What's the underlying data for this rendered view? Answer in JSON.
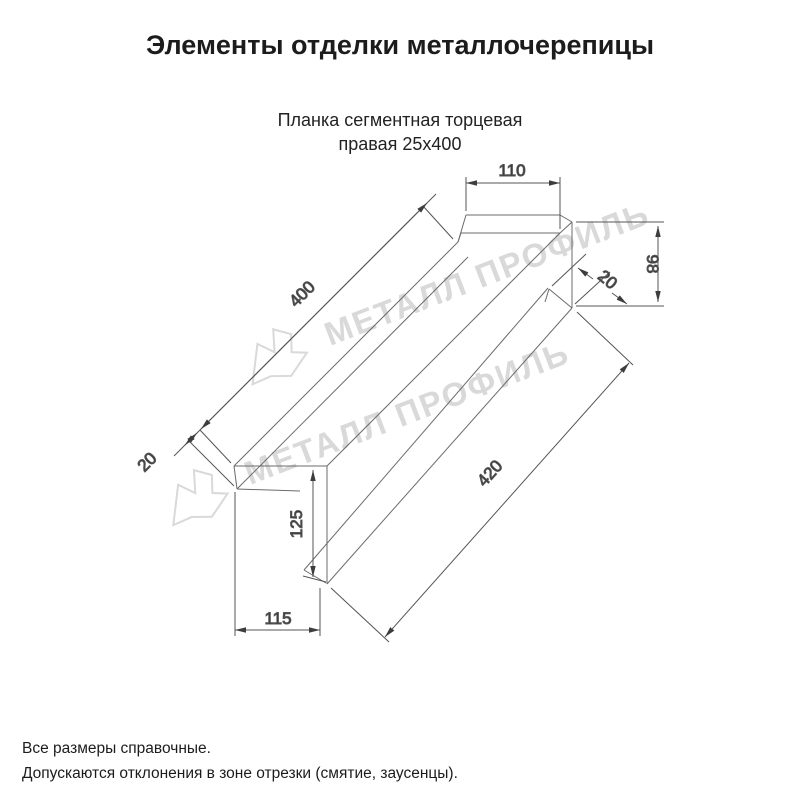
{
  "page": {
    "title": "Элементы отделки металлочерепицы",
    "subtitle_line1": "Планка сегментная торцевая",
    "subtitle_line2": "правая 25х400",
    "footer_line1": "Все размеры справочные.",
    "footer_line2": "Допускаются отклонения в зоне отрезки (смятие, заусенцы)."
  },
  "watermark": {
    "text": "МЕТАЛЛ ПРОФИЛЬ",
    "color": "#d9d9d9"
  },
  "drawing": {
    "dimensions": {
      "top_flange_width": "110",
      "right_face_height": "98",
      "right_hem": "20",
      "top_edge_length": "400",
      "left_hem": "20",
      "left_end_height": "125",
      "bottom_edge_length": "420",
      "left_end_width": "115"
    }
  }
}
